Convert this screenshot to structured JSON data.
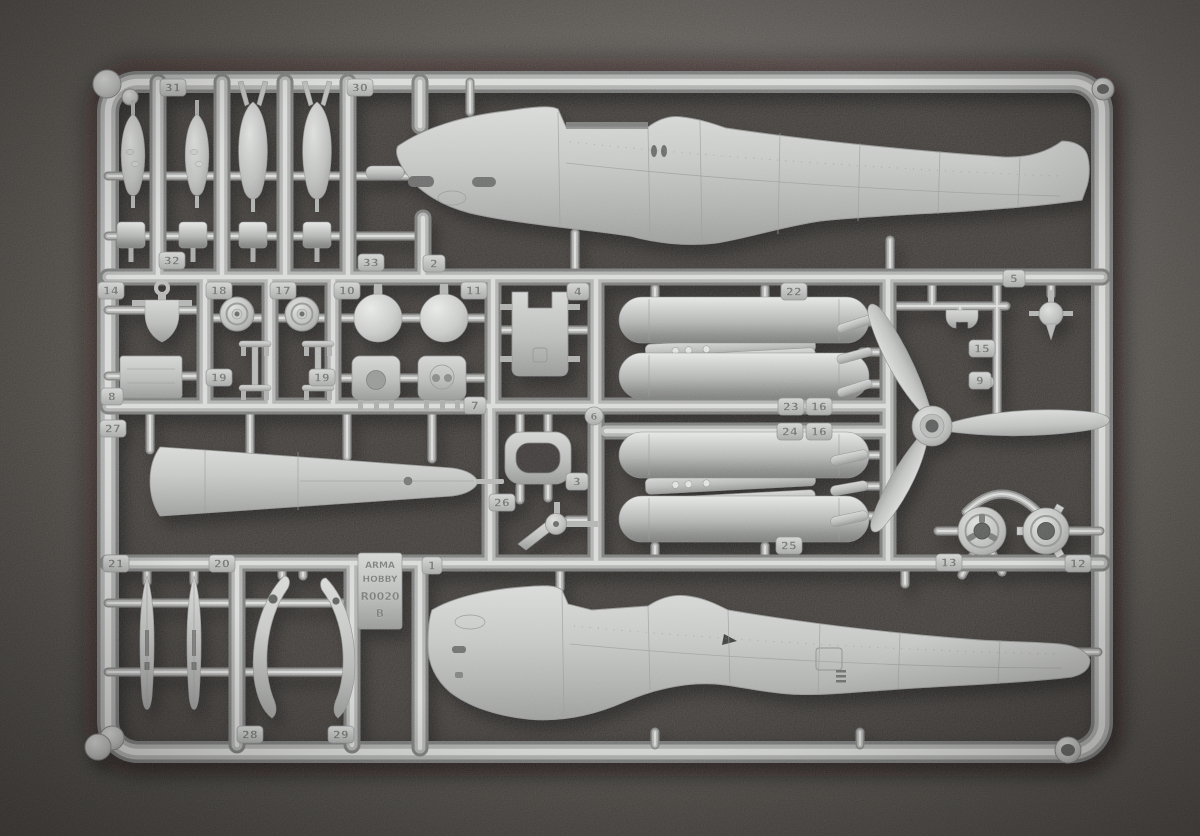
{
  "scene": {
    "description": "Photograph of a light-gray injection-molded model kit sprue with aircraft parts on a dark gray surface",
    "plastic_color": "#b6b8b7",
    "background_color": "#46423f",
    "foam_color": "#2b2826",
    "parts_visible": [
      "two fuselage halves",
      "bombs",
      "drop tanks",
      "three-blade propeller",
      "wheels",
      "cowling discs",
      "exhaust stacks",
      "cockpit parts",
      "fairing halves"
    ]
  },
  "sprue": {
    "brand_block": {
      "lines": [
        "ARMA",
        "HOBBY",
        "R0020",
        "B"
      ]
    },
    "part_tags": [
      {
        "label": "31"
      },
      {
        "label": "30"
      },
      {
        "label": "32"
      },
      {
        "label": "33"
      },
      {
        "label": "2"
      },
      {
        "label": "14"
      },
      {
        "label": "18"
      },
      {
        "label": "17"
      },
      {
        "label": "10"
      },
      {
        "label": "11"
      },
      {
        "label": "4"
      },
      {
        "label": "22"
      },
      {
        "label": "5"
      },
      {
        "label": "8"
      },
      {
        "label": "19"
      },
      {
        "label": "19"
      },
      {
        "label": "7"
      },
      {
        "label": "23"
      },
      {
        "label": "16"
      },
      {
        "label": "15"
      },
      {
        "label": "9"
      },
      {
        "label": "27"
      },
      {
        "label": "24"
      },
      {
        "label": "16"
      },
      {
        "label": "6"
      },
      {
        "label": "3"
      },
      {
        "label": "26"
      },
      {
        "label": "25"
      },
      {
        "label": "13"
      },
      {
        "label": "12"
      },
      {
        "label": "21"
      },
      {
        "label": "20"
      },
      {
        "label": "1"
      },
      {
        "label": "28"
      },
      {
        "label": "29"
      }
    ]
  }
}
